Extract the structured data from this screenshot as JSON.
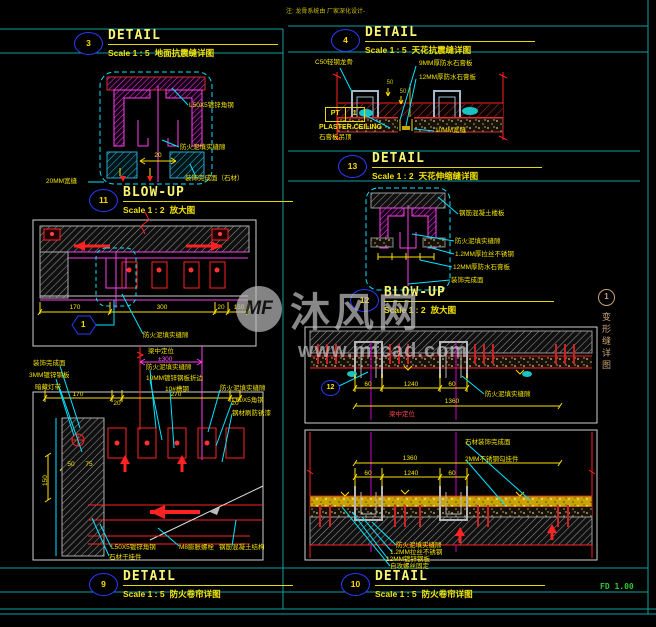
{
  "note_top": "注: 龙骨系统由 厂家深化设计-",
  "watermark": {
    "logo": "MF",
    "name": "沐风网",
    "url": "www.mfcad.com"
  },
  "side_tab": {
    "number": "1",
    "label": "变形缝详图"
  },
  "plot_stamp": "FD 1.00",
  "colors": {
    "frame_teal": "#0fa0a0",
    "text_yellow": "#f4e300",
    "cad_cyan": "#00e5ff",
    "cad_magenta": "#ff3df0",
    "cad_red": "#ff2222",
    "bubble_blue": "#2a3bff",
    "stamp_green": "#35c435",
    "watermark_gray": "#c2c2c2"
  },
  "titles": {
    "floor_seismic": {
      "num": "3",
      "title": "DETAIL",
      "scale": "Scale 1 : 5",
      "name": "地面抗震缝详图"
    },
    "ceiling_seismic": {
      "num": "4",
      "title": "DETAIL",
      "scale": "Scale 1 : 5",
      "name": "天花抗震缝详图"
    },
    "ceiling_expansion": {
      "num": "13",
      "title": "DETAIL",
      "scale": "Scale 1 : 2",
      "name": "天花伸缩缝详图"
    },
    "blowup_left": {
      "num": "11",
      "title": "BLOW-UP",
      "scale": "Scale 1 : 2",
      "name": "放大图"
    },
    "blowup_right": {
      "num": "12",
      "title": "BLOW-UP",
      "scale": "Scale 1 : 2",
      "name": "放大图"
    },
    "shutter_left": {
      "num": "9",
      "title": "DETAIL",
      "scale": "Scale 1 : 5",
      "name": "防火卷帘详图"
    },
    "shutter_right": {
      "num": "10",
      "title": "DETAIL",
      "scale": "Scale 1 : 5",
      "name": "防火卷帘详图"
    }
  },
  "blowup11": {
    "angle": "L50X5镀锌角钢",
    "fireclay": "防火泥填实缝隙",
    "finish": "装饰完成面（石材）",
    "gap": "20MM宽缝",
    "dim20": "20"
  },
  "ceiling4": {
    "keel": "C50轻钢龙骨",
    "gyp1": "9MM厚防水石膏板",
    "gyp2": "12MM厚防水石膏板",
    "pt": "PT",
    "pt_num": "1",
    "plaster_en": "PLASTER CEILING",
    "plaster_cn": "石膏板吊顶",
    "gap": "10MM宽缝",
    "dim50a": "50",
    "dim50b": "50"
  },
  "blowup12": {
    "slab": "钢筋混凝土楼板",
    "fireclay": "防火泥填实缝隙",
    "steel": "1.2MM厚拉丝不锈钢",
    "gyp": "12MM厚防水石膏板",
    "finish": "装饰完成面"
  },
  "plan3": {
    "fireclay": "防火泥填实缝隙",
    "hex_num": "1",
    "dims": {
      "d1": "170",
      "d2": "300",
      "d3": "20",
      "d4": "150"
    }
  },
  "section9": {
    "loc_label": "梁中定位",
    "loc_dim": "±300",
    "finish": "装饰完成面",
    "plate": "3MM镀锌钢板",
    "light": "暗藏灯带",
    "fireclay1": "防火泥填实缝隙",
    "fold": "10MM镀锌钢板折边",
    "channel": "10#槽钢",
    "fireclay2": "防火泥填实缝隙",
    "angle": "L50X5角钢",
    "paint": "钢材刷防锈漆",
    "dims": {
      "d1": "170",
      "d2": "20",
      "d3": "270",
      "d4": "20",
      "d5": "50",
      "d6": "75",
      "d7": "150"
    },
    "angle2": "L50X5镀锌角钢",
    "hanger": "石材干挂件",
    "bolt": "M8膨胀螺栓",
    "concrete": "钢筋混凝土结构"
  },
  "section10_top": {
    "marker": "12",
    "fireclay": "防火泥填实缝隙",
    "loc": "梁中定位",
    "dims": {
      "d60a": "60",
      "d1240": "1240",
      "d60b": "60",
      "total": "1360"
    }
  },
  "section10_bottom": {
    "finish": "石材装饰完成面",
    "hook": "2MM不锈钢勾挂件",
    "fireclay": "防火泥填实缝隙",
    "steel": "1.2MM拉丝不锈钢",
    "plate": "12MM镀锌钢板",
    "screws": "自攻螺丝固定",
    "dims": {
      "total": "1360",
      "d60a": "60",
      "d1240": "1240",
      "d60b": "60"
    }
  }
}
